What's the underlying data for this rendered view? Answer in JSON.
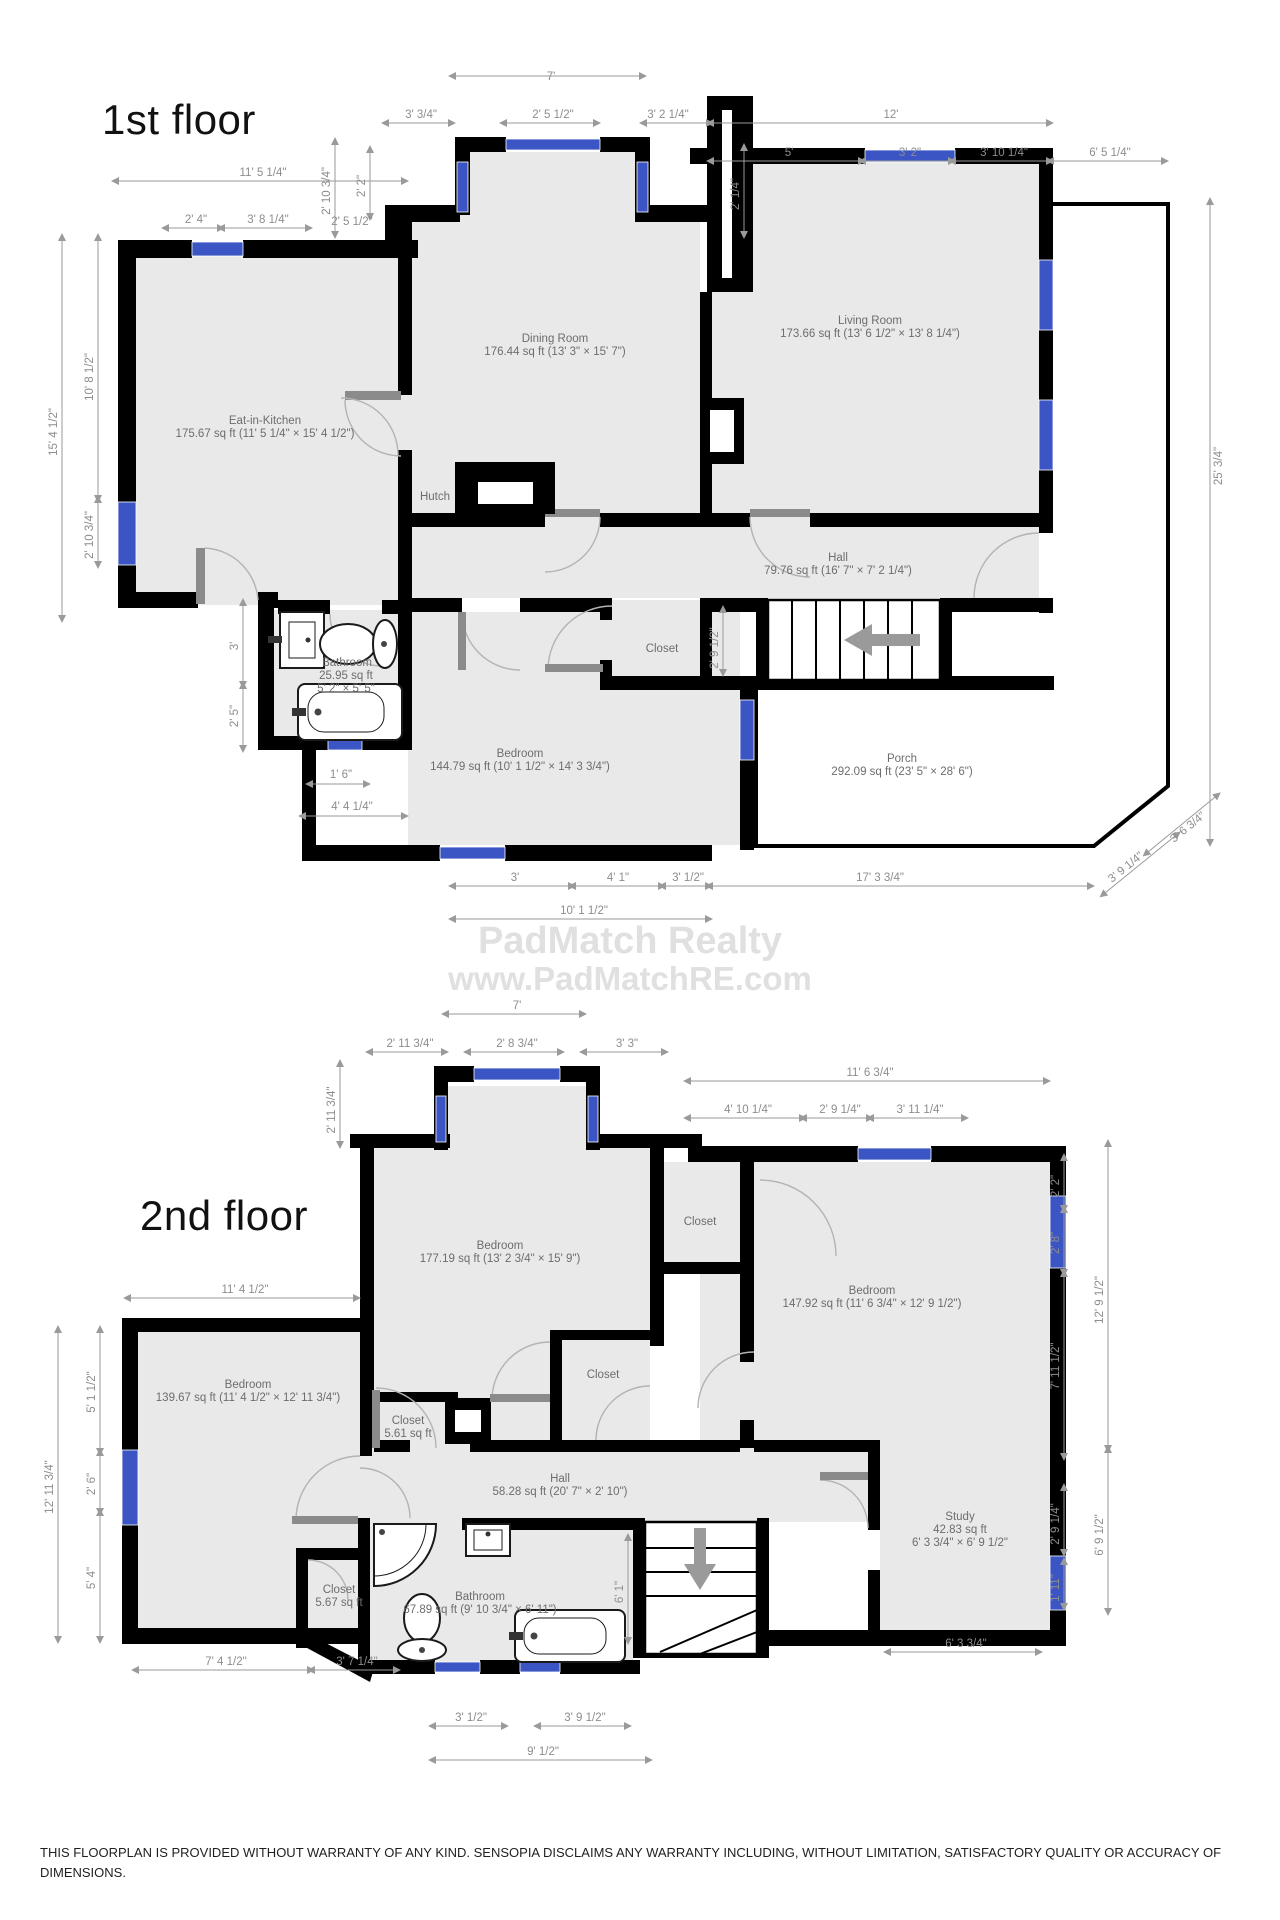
{
  "watermark": {
    "line1": "PadMatch Realty",
    "line2": "www.PadMatchRE.com"
  },
  "disclaimer": {
    "text": "THIS FLOORPLAN IS PROVIDED WITHOUT WARRANTY OF ANY KIND. SENSOPIA DISCLAIMS ANY WARRANTY INCLUDING, WITHOUT LIMITATION, SATISFACTORY QUALITY OR ACCURACY OF DIMENSIONS."
  },
  "colors": {
    "wall": "#000000",
    "room_fill": "#e9e9e9",
    "window": "#3b55c5",
    "dim_text": "#8d8d8d"
  },
  "floor1": {
    "title": "1st floor",
    "rooms": [
      {
        "name": "Eat-in-Kitchen",
        "area": "175.67 sq ft (11' 5 1/4\" × 15' 4 1/2\")"
      },
      {
        "name": "Dining Room",
        "area": "176.44 sq ft (13' 3\" × 15' 7\")"
      },
      {
        "name": "Living Room",
        "area": "173.66 sq ft (13' 6 1/2\" × 13' 8 1/4\")"
      },
      {
        "name": "Hutch"
      },
      {
        "name": "Hall",
        "area": "79.76 sq ft (16' 7\" × 7' 2 1/4\")"
      },
      {
        "name": "Closet"
      },
      {
        "name": "Bathroom",
        "area": "25.95 sq ft",
        "dims": "5' 2\" × 5' 5\""
      },
      {
        "name": "Bedroom",
        "area": "144.79 sq ft (10' 1 1/2\" × 14' 3 3/4\")"
      },
      {
        "name": "Porch",
        "area": "292.09 sq ft (23' 5\" × 28' 6\")"
      }
    ],
    "dims": [
      "7'",
      "3' 3/4\"",
      "2' 5 1/2\"",
      "3' 2 1/4\"",
      "12'",
      "5'",
      "3' 2\"",
      "3' 10 1/4\"",
      "6' 5 1/4\"",
      "11' 5 1/4\"",
      "2' 4\"",
      "3' 8 1/4\"",
      "2' 10 3/4\"",
      "2' 2\"",
      "2' 5 1/2\"",
      "2' 1/4\"",
      "25' 3/4\"",
      "15' 4 1/2\"",
      "10' 8 1/2\"",
      "2' 10 3/4\"",
      "3'",
      "2' 5\"",
      "1' 6\"",
      "4' 4 1/4\"",
      "2' 9 1/2\"",
      "3'",
      "4' 1\"",
      "3' 1/2\"",
      "17' 3 3/4\"",
      "10' 1 1/2\"",
      "3' 9 1/4\"",
      "3' 6 3/4\""
    ]
  },
  "floor2": {
    "title": "2nd floor",
    "rooms": [
      {
        "name": "Bedroom",
        "area": "177.19 sq ft (13' 2 3/4\" × 15' 9\")"
      },
      {
        "name": "Bedroom",
        "area": "147.92 sq ft (11' 6 3/4\" × 12' 9 1/2\")"
      },
      {
        "name": "Bedroom",
        "area": "139.67 sq ft (11' 4 1/2\" × 12' 11 3/4\")"
      },
      {
        "name": "Closet"
      },
      {
        "name": "Closet"
      },
      {
        "name": "Closet",
        "area": "5.61 sq ft"
      },
      {
        "name": "Hall",
        "area": "58.28 sq ft (20' 7\" × 2' 10\")"
      },
      {
        "name": "Closet",
        "area": "5.67 sq ft"
      },
      {
        "name": "Bathroom",
        "area": "67.89 sq ft (9' 10 3/4\" × 6' 11\")"
      },
      {
        "name": "Study",
        "area": "42.83 sq ft",
        "dims": "6' 3 3/4\" × 6' 9 1/2\""
      }
    ],
    "dims": [
      "7'",
      "2' 11 3/4\"",
      "2' 8 3/4\"",
      "3' 3\"",
      "11' 6 3/4\"",
      "4' 10 1/4\"",
      "2' 9 1/4\"",
      "3' 11 1/4\"",
      "2' 11 3/4\"",
      "11' 4 1/2\"",
      "5' 1 1/2\"",
      "2' 6\"",
      "5' 4\"",
      "12' 11 3/4\"",
      "2' 2\"",
      "2' 8\"",
      "7' 11 1/2\"",
      "12' 9 1/2\"",
      "2' 9 1/4\"",
      "6' 9 1/2\"",
      "1' 11\"",
      "7' 4 1/2\"",
      "3' 7 1/4\"",
      "3' 1/2\"",
      "3' 9 1/2\"",
      "9' 1/2\"",
      "6' 3 3/4\"",
      "6' 1\""
    ]
  }
}
